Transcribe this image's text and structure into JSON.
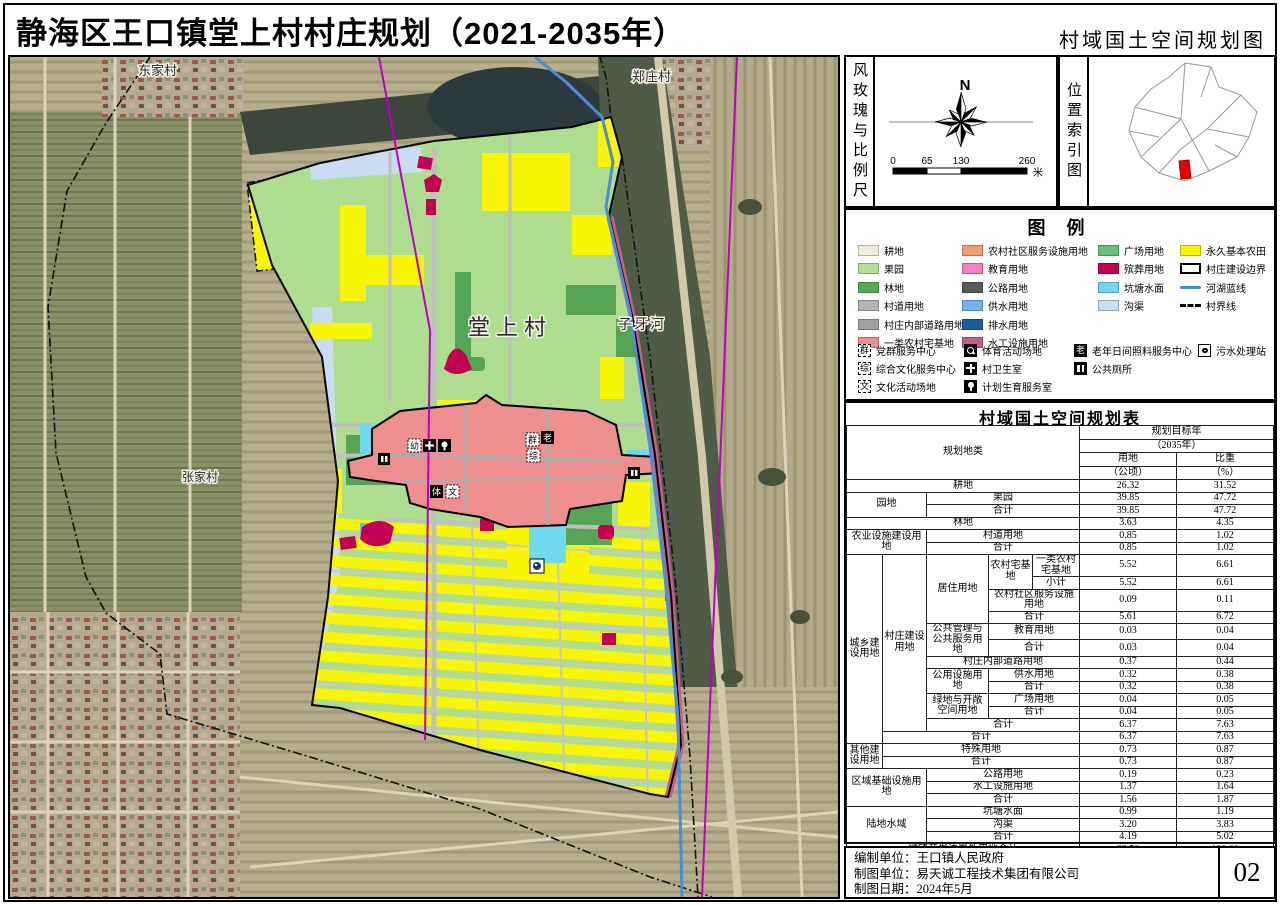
{
  "title": "静海区王口镇堂上村村庄规划（2021-2035年）",
  "subtitle": "村域国土空间规划图",
  "page_number": "02",
  "compass": {
    "panel_label": "风玫瑰与比例尺",
    "north_label": "N",
    "scale_ticks": [
      "0",
      "65",
      "130",
      "260"
    ],
    "scale_unit": "米"
  },
  "location_index": {
    "panel_label": "位置索引图",
    "highlight_color": "#e60000"
  },
  "legend": {
    "title": "图 例",
    "columns": [
      [
        {
          "label": "耕地",
          "type": "fill",
          "color": "#f1efdb"
        },
        {
          "label": "果园",
          "type": "fill",
          "color": "#b3e096"
        },
        {
          "label": "林地",
          "type": "fill",
          "color": "#55aa55"
        },
        {
          "label": "村道用地",
          "type": "fill",
          "color": "#b5b5b5"
        },
        {
          "label": "村庄内部道路用地",
          "type": "fill",
          "color": "#a0a0a0"
        },
        {
          "label": "一类农村宅基地",
          "type": "fill",
          "color": "#ee8f8f"
        }
      ],
      [
        {
          "label": "农村社区服务设施用地",
          "type": "fill",
          "color": "#f59b6d"
        },
        {
          "label": "教育用地",
          "type": "fill",
          "color": "#f57fc4"
        },
        {
          "label": "公路用地",
          "type": "fill",
          "color": "#595959"
        },
        {
          "label": "供水用地",
          "type": "fill",
          "color": "#72b4f2"
        },
        {
          "label": "排水用地",
          "type": "fill",
          "color": "#1a5e9e"
        },
        {
          "label": "水工设施用地",
          "type": "fill",
          "color": "#c0608c"
        }
      ],
      [
        {
          "label": "广场用地",
          "type": "fill",
          "color": "#67c17c"
        },
        {
          "label": "殡葬用地",
          "type": "fill",
          "color": "#c30052"
        },
        {
          "label": "坑塘水面",
          "type": "fill",
          "color": "#70d9f0"
        },
        {
          "label": "沟渠",
          "type": "fill",
          "color": "#cbdef5"
        }
      ],
      [
        {
          "label": "永久基本农田",
          "type": "fill",
          "color": "#f8f600"
        },
        {
          "label": "村庄建设边界",
          "type": "outline",
          "color": "#000000"
        },
        {
          "label": "河湖蓝线",
          "type": "line",
          "color": "#4a8fd3"
        },
        {
          "label": "村界线",
          "type": "dash",
          "color": "#000000"
        }
      ]
    ],
    "facilities": [
      [
        {
          "icon": "dash-char",
          "char": "群",
          "name": "party-service-icon",
          "label": "党群服务中心"
        },
        {
          "icon": "dash-char",
          "char": "综",
          "name": "culture-service-icon",
          "label": "综合文化服务中心"
        },
        {
          "icon": "dash-char",
          "char": "文",
          "name": "culture-ground-icon",
          "label": "文化活动场地"
        }
      ],
      [
        {
          "icon": "sport",
          "char": "",
          "name": "sports-ground-icon",
          "label": "体育活动场地"
        },
        {
          "icon": "cross",
          "char": "",
          "name": "clinic-icon",
          "label": "村卫生室"
        },
        {
          "icon": "hand",
          "char": "",
          "name": "family-planning-icon",
          "label": "计划生育服务室"
        }
      ],
      [
        {
          "icon": "solid-char",
          "char": "老",
          "name": "elder-care-icon",
          "label": "老年日间照料服务中心"
        },
        {
          "icon": "toilet",
          "char": "",
          "name": "public-toilet-icon",
          "label": "公共厕所"
        }
      ],
      [
        {
          "icon": "drop",
          "char": "",
          "name": "sewage-station-icon",
          "label": "污水处理站"
        }
      ]
    ]
  },
  "map": {
    "labels": {
      "village_nw": "东家村",
      "village_ne": "郑庄村",
      "village_main": "堂上村",
      "river": "子牙河",
      "village_w": "张家村"
    },
    "icon_chars": {
      "party": "群",
      "elder": "老",
      "culture_center": "综",
      "culture_ground": "文",
      "kindergarten": "幼",
      "sport": "体"
    },
    "colors": {
      "orchard": "#aedd90",
      "basic_farmland": "#f8f600",
      "forest": "#55a554",
      "homestead": "#ee8f8f",
      "cemetery": "#c30052",
      "pond": "#70d9f0",
      "ditch": "#c9dcf2",
      "river_blue_line": "#4a8fd3",
      "hydraulic_strip": "#c0608c",
      "boundary_magenta": "#c000c0"
    }
  },
  "table": {
    "title": "村域国土空间规划表",
    "rows": [
      {
        "cells": [
          {
            "t": "规划地类",
            "rs": 4,
            "cs": 5,
            "h": true
          },
          {
            "t": "规划目标年",
            "cs": 2,
            "h": true
          }
        ]
      },
      {
        "cells": [
          {
            "t": "（2035年）",
            "cs": 2,
            "h": true
          }
        ]
      },
      {
        "cells": [
          {
            "t": "用地",
            "h": true
          },
          {
            "t": "比重",
            "h": true
          }
        ]
      },
      {
        "cells": [
          {
            "t": "（公顷）",
            "h": true
          },
          {
            "t": "（%）",
            "h": true
          }
        ]
      },
      {
        "cells": [
          {
            "t": "耕地",
            "cs": 5
          },
          {
            "t": "26.32"
          },
          {
            "t": "31.52"
          }
        ]
      },
      {
        "cells": [
          {
            "t": "园地",
            "rs": 2,
            "cs": 2
          },
          {
            "t": "果园",
            "cs": 3
          },
          {
            "t": "39.85"
          },
          {
            "t": "47.72"
          }
        ]
      },
      {
        "cells": [
          {
            "t": "合计",
            "cs": 3
          },
          {
            "t": "39.85"
          },
          {
            "t": "47.72"
          }
        ]
      },
      {
        "cells": [
          {
            "t": "林地",
            "cs": 5
          },
          {
            "t": "3.63"
          },
          {
            "t": "4.35"
          }
        ]
      },
      {
        "cells": [
          {
            "t": "农业设施建设用地",
            "rs": 2,
            "cs": 2
          },
          {
            "t": "村道用地",
            "cs": 3
          },
          {
            "t": "0.85"
          },
          {
            "t": "1.02"
          }
        ]
      },
      {
        "cells": [
          {
            "t": "合计",
            "cs": 3
          },
          {
            "t": "0.85"
          },
          {
            "t": "1.02"
          }
        ]
      },
      {
        "cells": [
          {
            "t": "城乡建设用地",
            "rs": 13
          },
          {
            "t": "村庄建设用地",
            "rs": 12
          },
          {
            "t": "居住用地",
            "rs": 4
          },
          {
            "t": "农村宅基地",
            "rs": 2
          },
          {
            "t": "一类农村宅基地"
          },
          {
            "t": "5.52"
          },
          {
            "t": "6.61"
          }
        ]
      },
      {
        "cells": [
          {
            "t": "小计"
          },
          {
            "t": "5.52"
          },
          {
            "t": "6.61"
          }
        ]
      },
      {
        "cells": [
          {
            "t": "农村社区服务设施用地",
            "cs": 2
          },
          {
            "t": "0.09"
          },
          {
            "t": "0.11"
          }
        ]
      },
      {
        "cells": [
          {
            "t": "合计",
            "cs": 2
          },
          {
            "t": "5.61"
          },
          {
            "t": "6.72"
          }
        ]
      },
      {
        "cells": [
          {
            "t": "公共管理与公共服务用地",
            "rs": 2
          },
          {
            "t": "教育用地",
            "cs": 2
          },
          {
            "t": "0.03"
          },
          {
            "t": "0.04"
          }
        ]
      },
      {
        "cells": [
          {
            "t": "合计",
            "cs": 2
          },
          {
            "t": "0.03"
          },
          {
            "t": "0.04"
          }
        ]
      },
      {
        "cells": [
          {
            "t": "村庄内部道路用地",
            "cs": 3
          },
          {
            "t": "0.37"
          },
          {
            "t": "0.44"
          }
        ]
      },
      {
        "cells": [
          {
            "t": "公用设施用地",
            "rs": 2
          },
          {
            "t": "供水用地",
            "cs": 2
          },
          {
            "t": "0.32"
          },
          {
            "t": "0.38"
          }
        ]
      },
      {
        "cells": [
          {
            "t": "合计",
            "cs": 2
          },
          {
            "t": "0.32"
          },
          {
            "t": "0.38"
          }
        ]
      },
      {
        "cells": [
          {
            "t": "绿地与开敞空间用地",
            "rs": 2
          },
          {
            "t": "广场用地",
            "cs": 2
          },
          {
            "t": "0.04"
          },
          {
            "t": "0.05"
          }
        ]
      },
      {
        "cells": [
          {
            "t": "合计",
            "cs": 2
          },
          {
            "t": "0.04"
          },
          {
            "t": "0.05"
          }
        ]
      },
      {
        "cells": [
          {
            "t": "合计",
            "cs": 3
          },
          {
            "t": "6.37"
          },
          {
            "t": "7.63"
          }
        ]
      },
      {
        "cells": [
          {
            "t": "合计",
            "cs": 4
          },
          {
            "t": "6.37"
          },
          {
            "t": "7.63"
          }
        ]
      },
      {
        "cells": [
          {
            "t": "其他建设用地",
            "rs": 2
          },
          {
            "t": "特殊用地",
            "cs": 4
          },
          {
            "t": "0.73"
          },
          {
            "t": "0.87"
          }
        ]
      },
      {
        "cells": [
          {
            "t": "合计",
            "cs": 4
          },
          {
            "t": "0.73"
          },
          {
            "t": "0.87"
          }
        ]
      },
      {
        "cells": [
          {
            "t": "区域基础设施用地",
            "rs": 3,
            "cs": 2
          },
          {
            "t": "公路用地",
            "cs": 3
          },
          {
            "t": "0.19"
          },
          {
            "t": "0.23"
          }
        ]
      },
      {
        "cells": [
          {
            "t": "水工设施用地",
            "cs": 3
          },
          {
            "t": "1.37"
          },
          {
            "t": "1.64"
          }
        ]
      },
      {
        "cells": [
          {
            "t": "合计",
            "cs": 3
          },
          {
            "t": "1.56"
          },
          {
            "t": "1.87"
          }
        ]
      },
      {
        "cells": [
          {
            "t": "陆地水域",
            "rs": 3,
            "cs": 2
          },
          {
            "t": "坑塘水面",
            "cs": 3
          },
          {
            "t": "0.99"
          },
          {
            "t": "1.19"
          }
        ]
      },
      {
        "cells": [
          {
            "t": "沟渠",
            "cs": 3
          },
          {
            "t": "3.20"
          },
          {
            "t": "3.83"
          }
        ]
      },
      {
        "cells": [
          {
            "t": "合计",
            "cs": 3
          },
          {
            "t": "4.19"
          },
          {
            "t": "5.02"
          }
        ]
      },
      {
        "cells": [
          {
            "t": "城镇开发边界外用地合计",
            "cs": 5
          },
          {
            "t": "83.50"
          },
          {
            "t": "100.00"
          }
        ]
      },
      {
        "cells": [
          {
            "t": "村域总用地",
            "cs": 5
          },
          {
            "t": "83.50"
          },
          {
            "t": "100.00"
          }
        ]
      }
    ]
  },
  "credits": {
    "lines": [
      {
        "label": "编制单位：",
        "value": "王口镇人民政府"
      },
      {
        "label": "制图单位：",
        "value": "易天诚工程技术集团有限公司"
      },
      {
        "label": "制图日期：",
        "value": "2024年5月"
      }
    ]
  }
}
